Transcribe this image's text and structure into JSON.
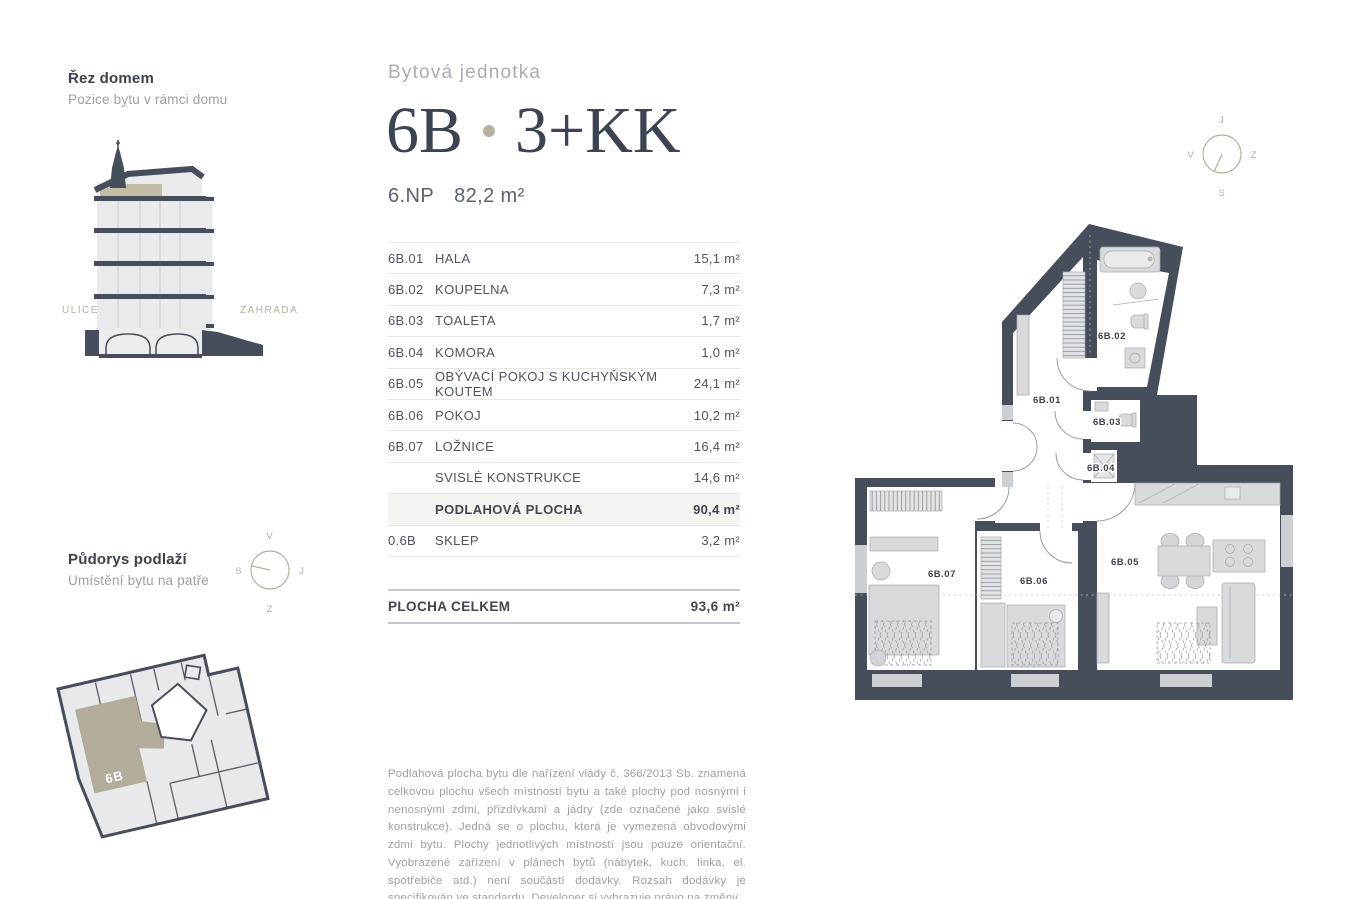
{
  "unit_header": {
    "eyebrow": "Bytová jednotka",
    "unit_id": "6B",
    "layout": "3+KK",
    "floor": "6.NP",
    "area": "82,2 m²"
  },
  "section_panel": {
    "title": "Řez domem",
    "subtitle": "Pozice bytu v rámci domu",
    "label_left": "ULICE",
    "label_right": "ZAHRADA"
  },
  "floor_panel": {
    "title": "Půdorys podlaží",
    "subtitle": "Umístění bytu na patře",
    "unit_label": "6B",
    "compass": {
      "top": "V",
      "left": "S",
      "right": "J",
      "bottom": "Z"
    }
  },
  "apartment_plan": {
    "compass": {
      "top": "J",
      "left": "V",
      "right": "Z",
      "bottom": "S"
    },
    "room_labels": [
      "6B.01",
      "6B.02",
      "6B.03",
      "6B.04",
      "6B.05",
      "6B.06",
      "6B.07"
    ]
  },
  "area_table": {
    "rows": [
      {
        "code": "6B.01",
        "name": "HALA",
        "value": "15,1 m²"
      },
      {
        "code": "6B.02",
        "name": "KOUPELNA",
        "value": "7,3 m²"
      },
      {
        "code": "6B.03",
        "name": "TOALETA",
        "value": "1,7 m²"
      },
      {
        "code": "6B.04",
        "name": "KOMORA",
        "value": "1,0 m²"
      },
      {
        "code": "6B.05",
        "name": "OBÝVACÍ POKOJ S KUCHYŇSKÝM KOUTEM",
        "value": "24,1 m²"
      },
      {
        "code": "6B.06",
        "name": "POKOJ",
        "value": "10,2 m²"
      },
      {
        "code": "6B.07",
        "name": "LOŽNICE",
        "value": "16,4 m²"
      },
      {
        "code": "",
        "name": "SVISLÉ KONSTRUKCE",
        "value": "14,6 m²"
      },
      {
        "code": "",
        "name": "PODLAHOVÁ PLOCHA",
        "value": "90,4 m²"
      },
      {
        "code": "0.6B",
        "name": "SKLEP",
        "value": "3,2 m²"
      }
    ],
    "total_label": "PLOCHA CELKEM",
    "total_value": "93,6 m²"
  },
  "disclaimer": "Podlahová plocha bytu dle nařízení vlády č. 366/2013 Sb. znamená celkovou plochu všech místností bytu a také plochy pod nosnými i nenosnými zdmi, přizdívkami a jádry (zde označené jako svislé konstrukce). Jedná se o plochu, která je vymezená obvodovými zdmi bytu. Plochy jednotlivých místností jsou pouze orientační. Vyobrazené zařízení v plánech bytů (nábytek, kuch. linka, el. spotřebiče atd.) není součástí dodávky. Rozsah dodávky je specifikován ve standardu. Developer si vyhrazuje právo na změny.",
  "colors": {
    "wall_dark": "#474e5b",
    "accent_beige": "#b6b19e",
    "light_fill": "#e9eaeb",
    "text_dark": "#3e4653",
    "text_gray": "#9ca0a6"
  }
}
